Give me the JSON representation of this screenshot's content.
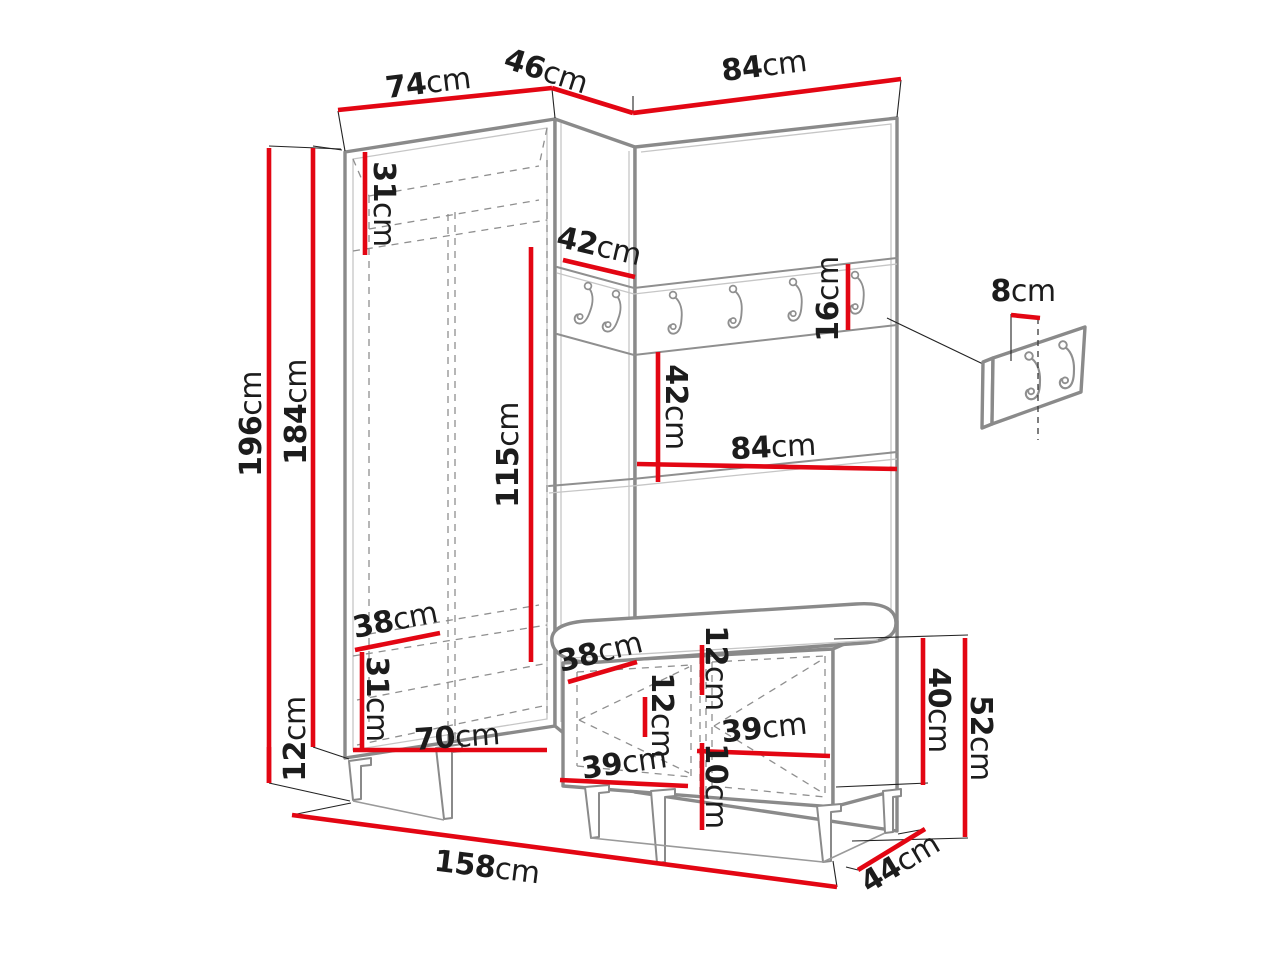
{
  "diagram": {
    "type": "furniture-dimension-diagram",
    "unit": "cm",
    "colors": {
      "dimension_line": "#e30613",
      "outline": "#8a8a8a",
      "text": "#1c1c1c",
      "background": "#ffffff"
    },
    "dimensions": [
      {
        "id": "top-width-74",
        "num": "74",
        "unit": "cm",
        "line": [
          [
            338,
            110
          ],
          [
            552,
            88
          ]
        ],
        "label": {
          "x": 428,
          "y": 83,
          "r": -7
        }
      },
      {
        "id": "top-corner-46",
        "num": "46",
        "unit": "cm",
        "line": [
          [
            552,
            88
          ],
          [
            633,
            113
          ]
        ],
        "label": {
          "x": 546,
          "y": 71,
          "r": 18
        }
      },
      {
        "id": "top-width-84",
        "num": "84",
        "unit": "cm",
        "line": [
          [
            633,
            113
          ],
          [
            901,
            79
          ]
        ],
        "label": {
          "x": 764,
          "y": 66,
          "r": -7
        }
      },
      {
        "id": "height-196",
        "num": "196",
        "unit": "cm",
        "line": [
          [
            269,
            148
          ],
          [
            269,
            783
          ]
        ],
        "label": {
          "x": 251,
          "y": 424,
          "r": -90
        }
      },
      {
        "id": "height-184",
        "num": "184",
        "unit": "cm",
        "line": [
          [
            313,
            148
          ],
          [
            313,
            747
          ]
        ],
        "label": {
          "x": 296,
          "y": 412,
          "r": -90
        }
      },
      {
        "id": "base-height-12",
        "num": "12",
        "unit": "cm",
        "line": [
          [
            269,
            747
          ],
          [
            269,
            783
          ]
        ],
        "label": {
          "x": 295,
          "y": 739,
          "r": -90
        }
      },
      {
        "id": "top-shelf-31",
        "num": "31",
        "unit": "cm",
        "line": [
          [
            365,
            152
          ],
          [
            365,
            255
          ]
        ],
        "label": {
          "x": 384,
          "y": 204,
          "r": 90
        }
      },
      {
        "id": "corner-depth-42",
        "num": "42",
        "unit": "cm",
        "line": [
          [
            563,
            260
          ],
          [
            635,
            277
          ]
        ],
        "label": {
          "x": 599,
          "y": 246,
          "r": 13
        }
      },
      {
        "id": "rail-height-16",
        "num": "16",
        "unit": "cm",
        "line": [
          [
            848,
            264
          ],
          [
            848,
            330
          ]
        ],
        "label": {
          "x": 828,
          "y": 299,
          "r": -90
        }
      },
      {
        "id": "interior-115",
        "num": "115",
        "unit": "cm",
        "line": [
          [
            531,
            247
          ],
          [
            531,
            662
          ]
        ],
        "label": {
          "x": 508,
          "y": 455,
          "r": -90
        }
      },
      {
        "id": "niche-height-42",
        "num": "42",
        "unit": "cm",
        "line": [
          [
            658,
            352
          ],
          [
            658,
            482
          ]
        ],
        "label": {
          "x": 676,
          "y": 407,
          "r": 90
        }
      },
      {
        "id": "niche-width-84",
        "num": "84",
        "unit": "cm",
        "line": [
          [
            637,
            464
          ],
          [
            897,
            469
          ]
        ],
        "label": {
          "x": 773,
          "y": 447,
          "r": -3
        }
      },
      {
        "id": "depth-38-left",
        "num": "38",
        "unit": "cm",
        "line": [
          [
            355,
            650
          ],
          [
            440,
            633
          ]
        ],
        "label": {
          "x": 395,
          "y": 620,
          "r": -11
        }
      },
      {
        "id": "lower-31",
        "num": "31",
        "unit": "cm",
        "line": [
          [
            362,
            652
          ],
          [
            362,
            748
          ]
        ],
        "label": {
          "x": 377,
          "y": 699,
          "r": 90
        }
      },
      {
        "id": "bottom-width-70",
        "num": "70",
        "unit": "cm",
        "line": [
          [
            353,
            750
          ],
          [
            547,
            750
          ]
        ],
        "label": {
          "x": 457,
          "y": 737,
          "r": -4
        }
      },
      {
        "id": "bench-depth-38",
        "num": "38",
        "unit": "cm",
        "line": [
          [
            568,
            682
          ],
          [
            637,
            662
          ]
        ],
        "label": {
          "x": 600,
          "y": 652,
          "r": -14
        }
      },
      {
        "id": "bench-top-12",
        "num": "12",
        "unit": "cm",
        "line": [
          [
            702,
            645
          ],
          [
            702,
            695
          ]
        ],
        "label": {
          "x": 716,
          "y": 668,
          "r": 90
        }
      },
      {
        "id": "bench-inner-12",
        "num": "12",
        "unit": "cm",
        "line": [
          [
            645,
            697
          ],
          [
            645,
            737
          ]
        ],
        "label": {
          "x": 662,
          "y": 715,
          "r": 90
        }
      },
      {
        "id": "bench-39-right",
        "num": "39",
        "unit": "cm",
        "line": [
          [
            697,
            751
          ],
          [
            830,
            756
          ]
        ],
        "label": {
          "x": 764,
          "y": 728,
          "r": -6
        }
      },
      {
        "id": "bench-39-left",
        "num": "39",
        "unit": "cm",
        "line": [
          [
            560,
            780
          ],
          [
            688,
            786
          ]
        ],
        "label": {
          "x": 624,
          "y": 763,
          "r": -8
        }
      },
      {
        "id": "bench-plinth-10",
        "num": "10",
        "unit": "cm",
        "line": [
          [
            702,
            743
          ],
          [
            702,
            830
          ]
        ],
        "label": {
          "x": 716,
          "y": 786,
          "r": 90
        }
      },
      {
        "id": "bench-height-40",
        "num": "40",
        "unit": "cm",
        "line": [
          [
            923,
            638
          ],
          [
            923,
            785
          ]
        ],
        "label": {
          "x": 939,
          "y": 710,
          "r": 90
        }
      },
      {
        "id": "bench-total-52",
        "num": "52",
        "unit": "cm",
        "line": [
          [
            965,
            638
          ],
          [
            965,
            837
          ]
        ],
        "label": {
          "x": 981,
          "y": 738,
          "r": 90
        }
      },
      {
        "id": "total-width-158",
        "num": "158",
        "unit": "cm",
        "line": [
          [
            292,
            815
          ],
          [
            837,
            887
          ]
        ],
        "label": {
          "x": 487,
          "y": 867,
          "r": 7
        }
      },
      {
        "id": "bench-depth-44",
        "num": "44",
        "unit": "cm",
        "line": [
          [
            858,
            870
          ],
          [
            925,
            829
          ]
        ],
        "label": {
          "x": 900,
          "y": 863,
          "r": -31
        }
      },
      {
        "id": "panel-hook-8",
        "num": "8",
        "unit": "cm",
        "line": [
          [
            1011,
            315
          ],
          [
            1040,
            318
          ]
        ],
        "label": {
          "x": 1023,
          "y": 291,
          "r": 0
        }
      }
    ]
  }
}
